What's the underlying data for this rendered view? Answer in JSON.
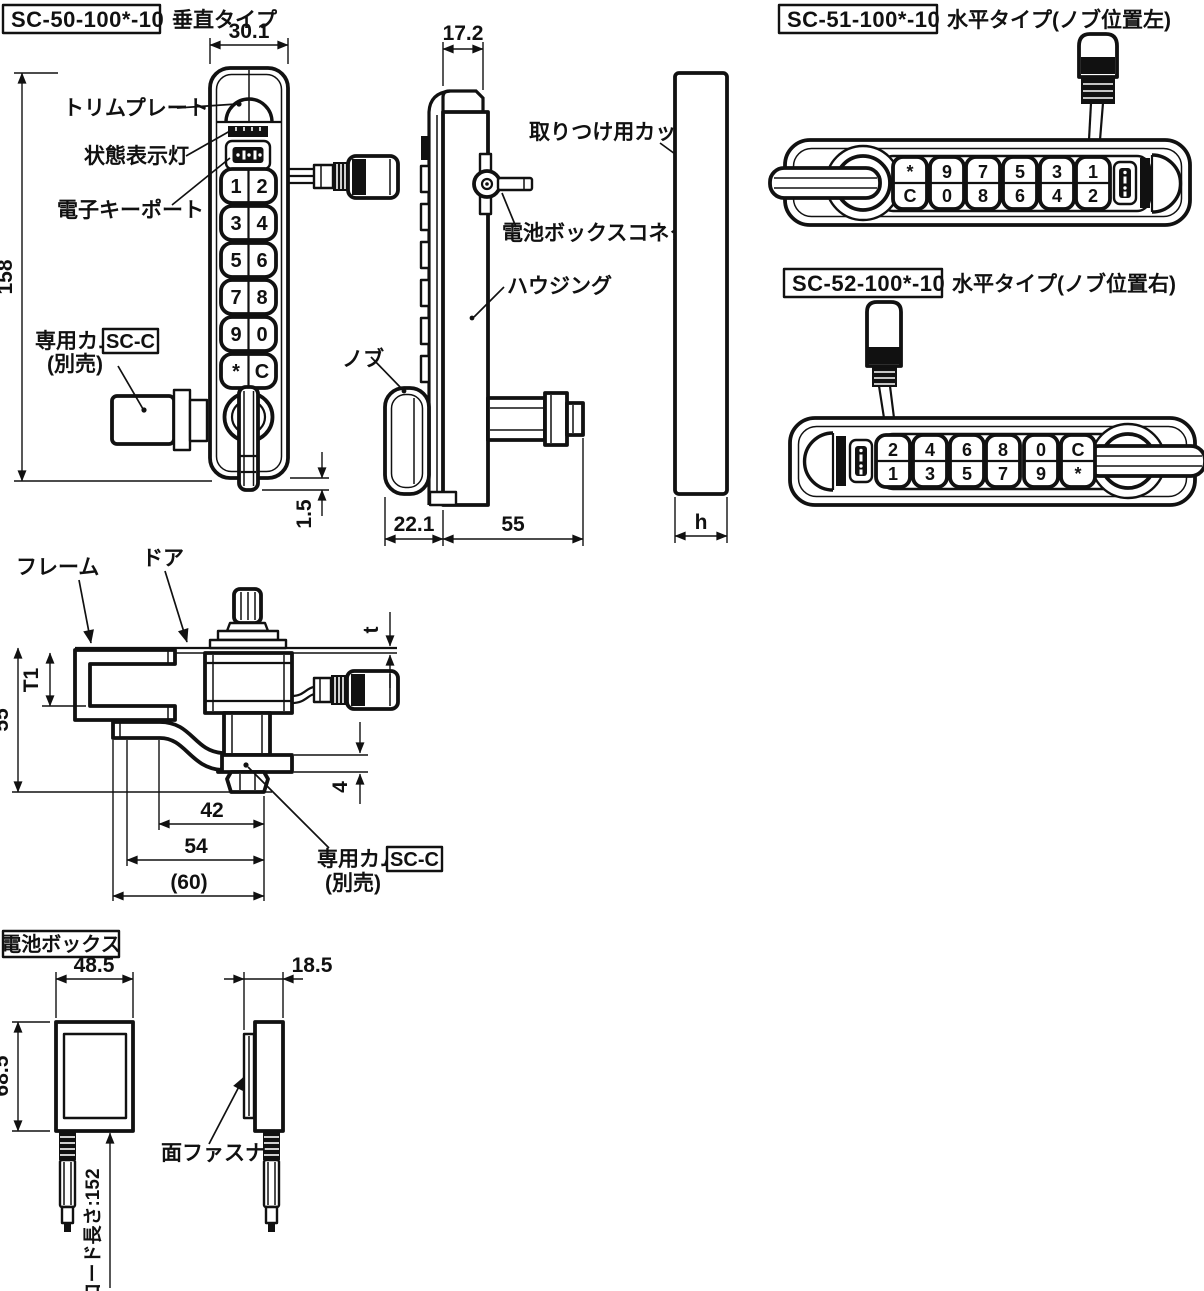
{
  "page": {
    "sc50": {
      "model": "SC-50-100*-10",
      "type": "垂直タイプ",
      "dims": {
        "width": "30.1",
        "height": "158",
        "bottom": "1.5"
      },
      "labels": {
        "trim_plate": "トリムプレート",
        "status_light": "状態表示灯",
        "key_port": "電子キーポート",
        "cam": "専用カム",
        "cam_model": "SC-C",
        "cam_note": "(別売)"
      },
      "keys": [
        [
          "1",
          "2"
        ],
        [
          "3",
          "4"
        ],
        [
          "5",
          "6"
        ],
        [
          "7",
          "8"
        ],
        [
          "9",
          "0"
        ],
        [
          "*",
          "C"
        ]
      ]
    },
    "side": {
      "dims": {
        "depth": "17.2",
        "knob": "22.1",
        "body": "55",
        "cup_h": "h"
      },
      "labels": {
        "cup": "取りつけ用カップ",
        "connector": "電池ボックスコネクタ",
        "housing": "ハウジング",
        "knob": "ノブ"
      }
    },
    "sc51": {
      "model": "SC-51-100*-10",
      "type": "水平タイプ(ノブ位置左)",
      "keys": [
        [
          "*",
          "C"
        ],
        [
          "9",
          "0"
        ],
        [
          "7",
          "8"
        ],
        [
          "5",
          "6"
        ],
        [
          "3",
          "4"
        ],
        [
          "1",
          "2"
        ]
      ]
    },
    "sc52": {
      "model": "SC-52-100*-10",
      "type": "水平タイプ(ノブ位置右)",
      "keys": [
        [
          "2",
          "1"
        ],
        [
          "4",
          "3"
        ],
        [
          "6",
          "5"
        ],
        [
          "8",
          "7"
        ],
        [
          "0",
          "9"
        ],
        [
          "C",
          "*"
        ]
      ]
    },
    "install": {
      "labels": {
        "frame": "フレーム",
        "door": "ドア",
        "cam": "専用カム",
        "cam_model": "SC-C",
        "cam_note": "(別売)"
      },
      "dims": {
        "t": "t",
        "t1": "T1",
        "h55": "55",
        "d4": "4",
        "d42": "42",
        "d54": "54",
        "d60": "(60)"
      }
    },
    "battery": {
      "title": "電池ボックス",
      "labels": {
        "fastener": "面ファスナ"
      },
      "dims": {
        "w": "48.5",
        "h": "68.5",
        "d": "18.5",
        "cord": "コード長さ:152"
      }
    }
  }
}
